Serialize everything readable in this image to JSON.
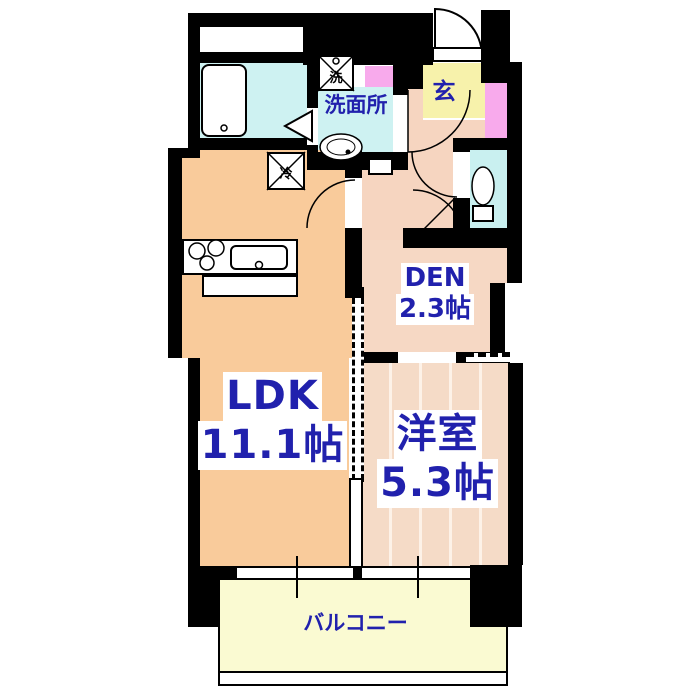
{
  "plan": {
    "title": "apartment floor plan",
    "rooms": {
      "ldk": {
        "name": "LDK",
        "size": "11.1帖"
      },
      "western": {
        "name": "洋室",
        "size": "5.3帖"
      },
      "den": {
        "name": "DEN",
        "size": "2.3帖"
      },
      "washroom": {
        "name": "洗面所"
      },
      "entrance": {
        "name": "玄"
      },
      "balcony": {
        "name": "バルコニー"
      }
    },
    "symbols": {
      "washing_machine": "洗",
      "refrigerator": "冷"
    },
    "colors": {
      "wall": "#000000",
      "ldk_floor": "#f9cb9b",
      "hall_floor": "#f6d5c0",
      "den_floor": "#f6d8c4",
      "western_floor": "#f5dbc7",
      "bath_floor": "#cef2f2",
      "toilet_floor": "#c9f0f0",
      "entrance_floor": "#f7f2ab",
      "balcony_floor": "#fafad2",
      "cabinet_pink": "#f8aaec",
      "label_text": "#2121ad"
    }
  }
}
